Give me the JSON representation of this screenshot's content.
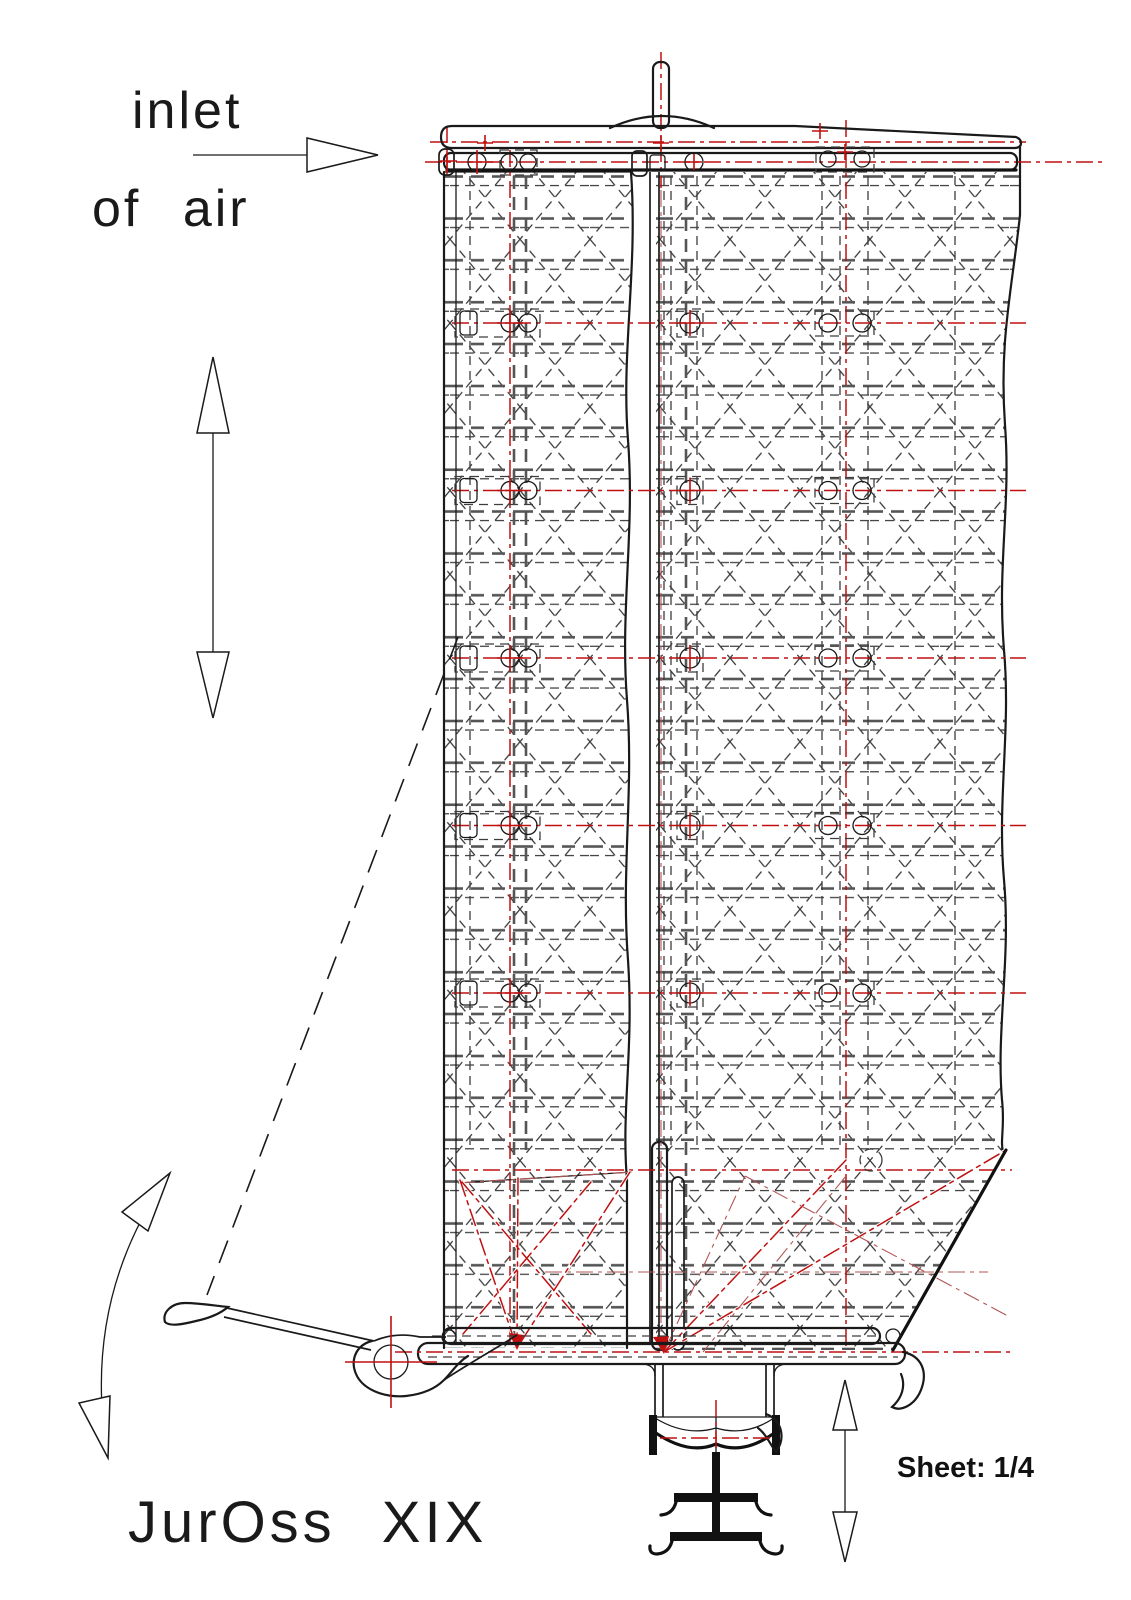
{
  "drawing": {
    "labels": {
      "inlet_line1": "inlet",
      "inlet_line2": "of air",
      "title": "JurOss XIX",
      "sheet": "Sheet: 1/4"
    },
    "colors": {
      "background": "#ffffff",
      "line": "#1a1a1a",
      "hidden_line": "#4a4a4a",
      "centerline_red": "#c01010",
      "centerline_dim_red": "#b25555"
    },
    "icons": [
      "air-inlet-arrow",
      "vertical-travel-arrow",
      "swing-arc-arrow",
      "vertical-lift-arrow"
    ]
  }
}
